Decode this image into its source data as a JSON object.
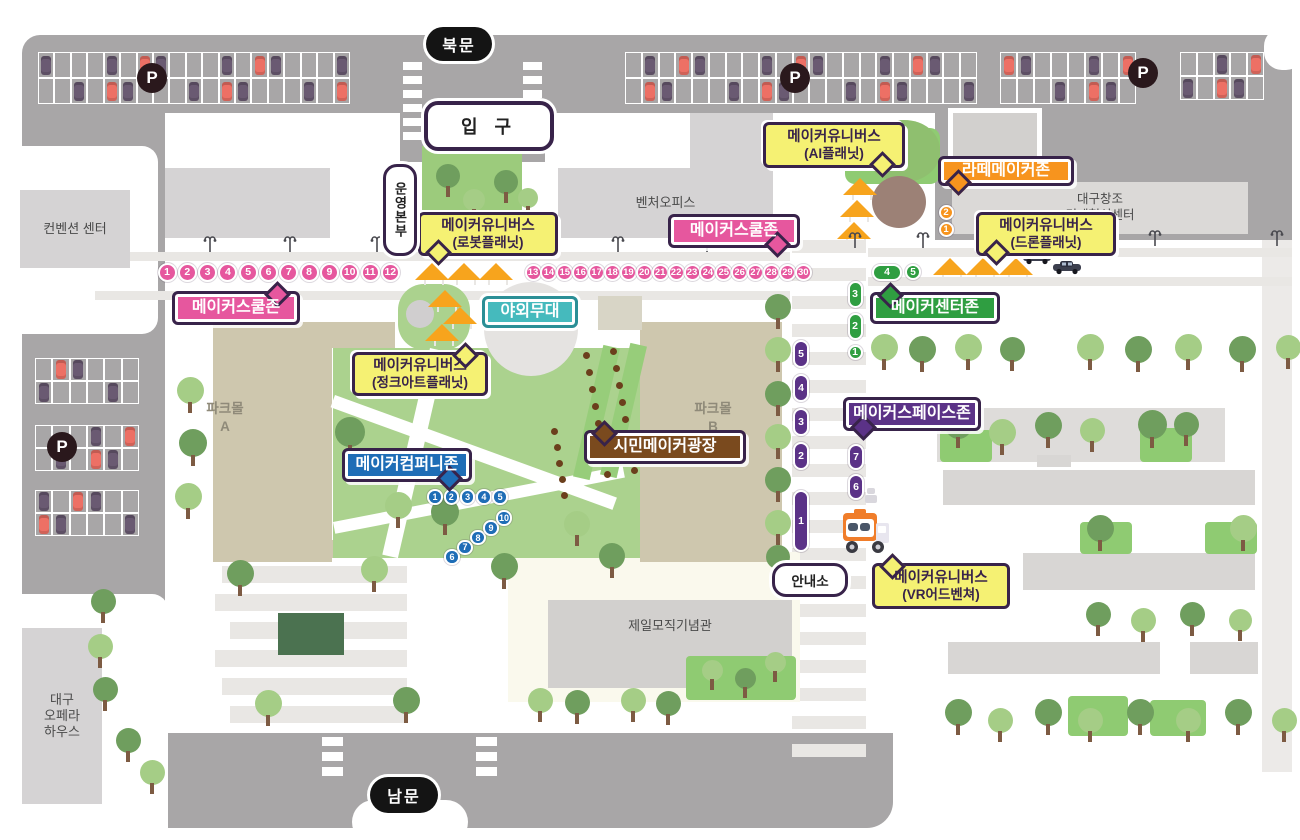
{
  "gates": {
    "north": "북문",
    "entrance": "입 구",
    "south": "남문",
    "ops": "운영본부",
    "info": "안내소",
    "parking": "P"
  },
  "buildings": {
    "convention": "컨벤션 센터",
    "venture": "벤처오피스",
    "innovation_line1": "대구창조",
    "innovation_line2": "경제혁신센터",
    "parkmall_a_line1": "파크몰",
    "parkmall_a_line2": "A",
    "parkmall_b_line1": "파크몰",
    "parkmall_b_line2": "B",
    "cheil": "제일모직기념관",
    "opera_line1": "대구",
    "opera_line2": "오페라",
    "opera_line3": "하우스"
  },
  "zones": [
    {
      "id": "ai",
      "label": "메이커유니버스",
      "sub": "(AI플래닛)",
      "color": "yellow"
    },
    {
      "id": "latte",
      "label": "라떼메이커존",
      "color": "orange"
    },
    {
      "id": "robot",
      "label": "메이커유니버스",
      "sub": "(로봇플래닛)",
      "color": "yellow"
    },
    {
      "id": "school-west",
      "label": "메이커스쿨존",
      "color": "pink"
    },
    {
      "id": "school-east",
      "label": "메이커스쿨존",
      "color": "pink"
    },
    {
      "id": "drone",
      "label": "메이커유니버스",
      "sub": "(드론플래닛)",
      "color": "yellow"
    },
    {
      "id": "center",
      "label": "메이커센터존",
      "color": "green"
    },
    {
      "id": "stage",
      "label": "야외무대",
      "color": "teal"
    },
    {
      "id": "junkart",
      "label": "메이커유니버스",
      "sub": "(정크아트플래닛)",
      "color": "yellow"
    },
    {
      "id": "space",
      "label": "메이커스페이스존",
      "color": "purple"
    },
    {
      "id": "citizen",
      "label": "시민메이커광장",
      "color": "brown"
    },
    {
      "id": "company",
      "label": "메이커컴퍼니존",
      "color": "blue"
    },
    {
      "id": "vr",
      "label": "메이커유니버스",
      "sub": "(VR어드벤쳐)",
      "color": "yellow"
    }
  ],
  "markers": {
    "pink_west": [
      "1",
      "2",
      "3",
      "4",
      "5",
      "6",
      "7",
      "8",
      "9",
      "10",
      "11",
      "12"
    ],
    "pink_east": [
      "13",
      "14",
      "15",
      "16",
      "17",
      "18",
      "19",
      "20",
      "21",
      "22",
      "23",
      "24",
      "25",
      "26",
      "27",
      "28",
      "29",
      "30"
    ],
    "orange": [
      "2",
      "1"
    ],
    "green_horizontal": [
      "4",
      "5"
    ],
    "green_vertical": [
      "3",
      "2",
      "1"
    ],
    "purple_vertical": [
      "5",
      "4",
      "3",
      "2",
      "1"
    ],
    "purple_vertical_2": [
      "7",
      "6"
    ],
    "blue_row": [
      "1",
      "2",
      "3",
      "4",
      "5"
    ],
    "blue_diagonal": [
      "6",
      "7",
      "8",
      "9",
      "10"
    ]
  },
  "colors": {
    "pink": "#e6579e",
    "yellow": "#f5f173",
    "orange": "#f7941e",
    "green": "#2f9e41",
    "teal": "#45babd",
    "purple": "#5b3287",
    "blue": "#1e6db6",
    "brown": "#7a4a1e",
    "road": "#a8a6a7",
    "outline": "#38234a"
  }
}
